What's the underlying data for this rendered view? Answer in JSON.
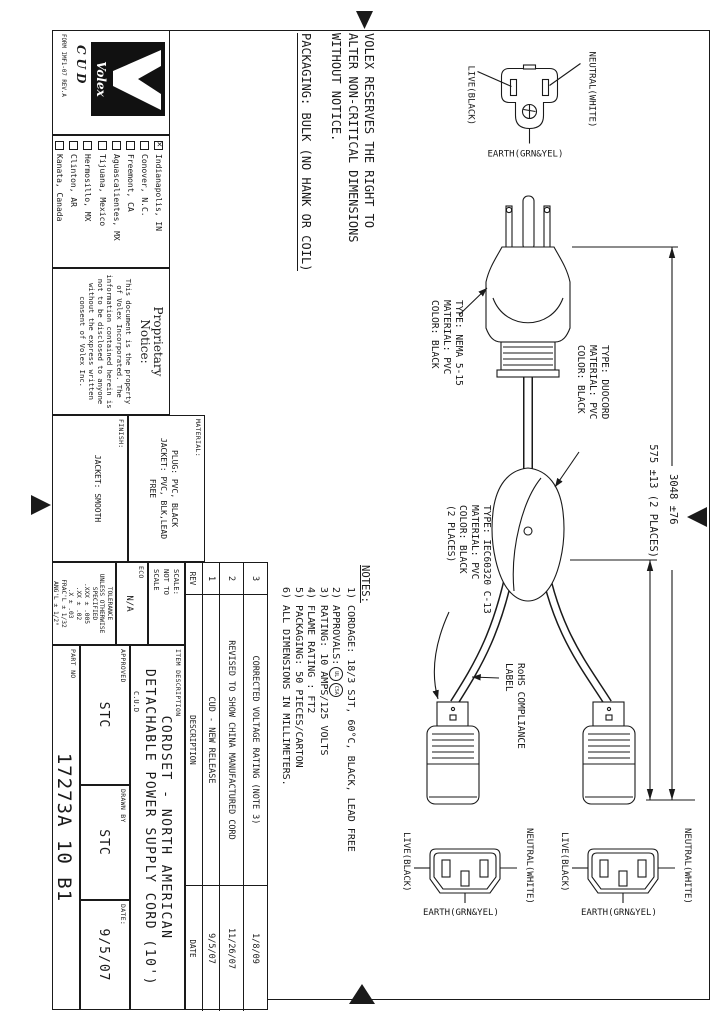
{
  "sheet": {
    "reserves_note_lines": [
      "VOLEX RESERVES THE RIGHT TO",
      "ALTER NON-CRITICAL DIMENSIONS",
      "WITHOUT NOTICE."
    ],
    "packaging_note": "PACKAGING: BULK (NO HANK OR COIL)",
    "logo": {
      "brand": "Volex",
      "cud": "CUD",
      "form": "FORM IMF1-07 REV.A"
    },
    "locations": [
      {
        "label": "Indianapolis, IN",
        "checked": true
      },
      {
        "label": "Conover, N.C.",
        "checked": false
      },
      {
        "label": "Freemont, CA",
        "checked": false
      },
      {
        "label": "Aguascalientes, MX",
        "checked": false
      },
      {
        "label": "Tijuana, Mexico",
        "checked": false
      },
      {
        "label": "Hermosillo, MX",
        "checked": false
      },
      {
        "label": "Clinton, AR",
        "checked": false
      },
      {
        "label": "Kanata, Canada",
        "checked": false
      }
    ],
    "proprietary": {
      "heading_line1": "Proprietary",
      "heading_line2": "Notice:",
      "body_lines": [
        "This document is the property",
        "of Volex Incorporated. The",
        "information contained herein is",
        "not to be disclosed to anyone",
        "without the express written",
        "consent of Volex Inc."
      ]
    },
    "material": {
      "label": "MATERIAL:",
      "lines": [
        "PLUG: PVC, BLACK",
        "JACKET: PVC, BLK,LEAD",
        "FREE"
      ]
    },
    "finish": {
      "label": "FINISH:",
      "value": "JACKET: SMOOTH"
    },
    "scale": {
      "label": "SCALE:",
      "value_lines": [
        "NOT TO",
        "SCALE"
      ]
    },
    "eco": {
      "label": "ECO",
      "value": "N/A"
    },
    "tolerance_lines": [
      "TOLERANCE",
      "UNLESS OTHERWISE",
      "SPECIFIED",
      ".XXX ± .005",
      ".XX ± .02",
      ".X ± .03",
      "FRAC'L ± 1/32",
      "ANG'L ± 1/2°"
    ],
    "item_description": {
      "label": "ITEM DESCRIPTION",
      "line1": "CORDSET - NORTH AMERICAN",
      "line2": "DETACHABLE POWER SUPPLY CORD (10')",
      "site": "C.U.D"
    },
    "approved": {
      "label": "APPROVED",
      "value": "STC"
    },
    "drawn_by": {
      "label": "DRAWN BY",
      "value": "STC"
    },
    "date": {
      "label": "DATE:",
      "value": "9/5/07"
    },
    "part_no": {
      "label": "PART NO",
      "value": "17273A 10 B1"
    },
    "rev_table": {
      "headers": {
        "rev": "REV",
        "description": "DESCRIPTION",
        "date": "DATE"
      },
      "rows": [
        {
          "rev": "3",
          "description": "CORRECTED VOLTAGE RATING (NOTE 3)",
          "date": "1/8/09"
        },
        {
          "rev": "2",
          "description": "REVISED TO SHOW CHINA MANUFACTURED CORD",
          "date": "11/26/07"
        },
        {
          "rev": "1",
          "description": "CUD - NEW RELEASE",
          "date": "9/5/07"
        }
      ]
    },
    "notes": {
      "heading": "NOTES:",
      "line1": "1) CORDAGE: 18/3 SJT, 60°C, BLACK, LEAD FREE",
      "line2": "2) APPROVALS:",
      "approvals_marks": [
        "UL",
        "CSA"
      ],
      "line3": "3) RATING: 10 AMPS/125 VOLTS",
      "line4": "4) FLAME RATING : FT2",
      "line5": "5) PACKAGING: 50 PIECES/CARTON",
      "line6": "6) ALL DIMENSIONS IN MILLIMETERS."
    },
    "labels": {
      "nema": "TYPE: NEMA 5-15\nMATERIAL: PVC\nCOLOR: BLACK",
      "duocord": "TYPE: DUOCORD\nMATERIAL: PVC\nCOLOR: BLACK",
      "iec": "TYPE: IEC60320 C-13\nMATERIAL: PVC\nCOLOR: BLACK\n(2 PLACES)",
      "rohs": "RoHS COMPLIANCE\nLABEL"
    },
    "dimensions": {
      "overall": "3048 ±76",
      "leg": "575 ±13 (2 PLACES)"
    },
    "face_labels": {
      "live": "LIVE(BLACK)",
      "neutral": "NEUTRAL(WHITE)",
      "earth": "EARTH(GRN&YEL)"
    }
  }
}
